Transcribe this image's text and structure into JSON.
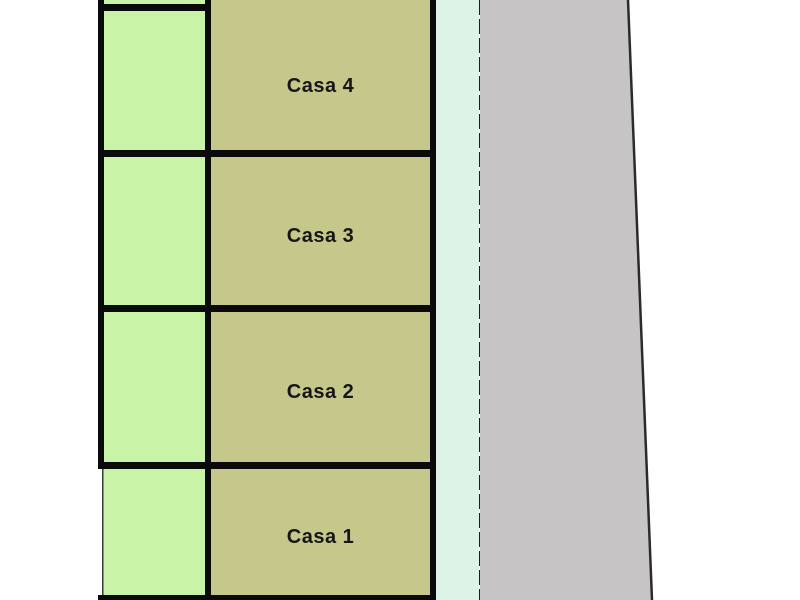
{
  "plan": {
    "houses": [
      {
        "label": "Casa 4"
      },
      {
        "label": "Casa 3"
      },
      {
        "label": "Casa 2"
      },
      {
        "label": "Casa 1"
      }
    ],
    "colors": {
      "lot_green": "#c9f4a7",
      "house_olive": "#c6c78a",
      "path_mint": "#def3e7",
      "road_gray": "#c6c4c4",
      "border_black": "#0a0a0a",
      "dash_dark": "#1c1c1c",
      "road_edge": "#2b2b2b"
    }
  }
}
